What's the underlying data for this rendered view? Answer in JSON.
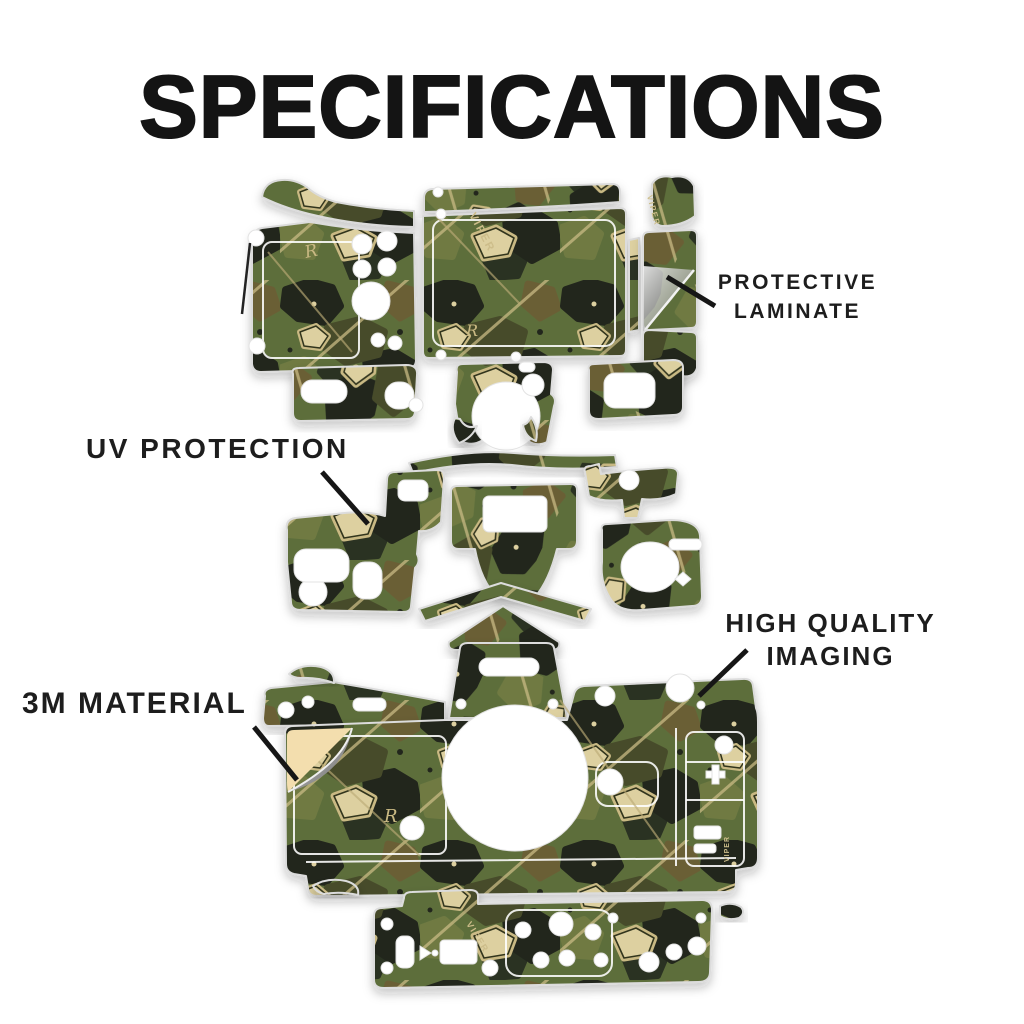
{
  "title": "SPECIFICATIONS",
  "callouts": {
    "protective_laminate": {
      "line1": "PROTECTIVE",
      "line2": "LAMINATE"
    },
    "uv_protection": {
      "label": "UV PROTECTION"
    },
    "high_quality_imaging": {
      "line1": "HIGH QUALITY",
      "line2": "IMAGING"
    },
    "material_3m": {
      "label": "3M MATERIAL"
    }
  },
  "skin_markings": {
    "brand": "VIPER",
    "monogram": "R"
  },
  "palette": {
    "background": "#ffffff",
    "text": "#1b1b1b",
    "callout_line": "#161616",
    "camo_base_green": "#5d6e3b",
    "camo_olive": "#6f7a42",
    "camo_dark_olive": "#474c2a",
    "camo_black": "#22261d",
    "camo_brown": "#6b5e35",
    "camo_tan": "#c9b983",
    "camo_cream": "#ddd0a0",
    "cut_outline": "#dcdcdc",
    "peel_backing": "#f3deae",
    "peel_foil": "#9a9a9a",
    "laminate_foil": "#c5c5c5"
  }
}
